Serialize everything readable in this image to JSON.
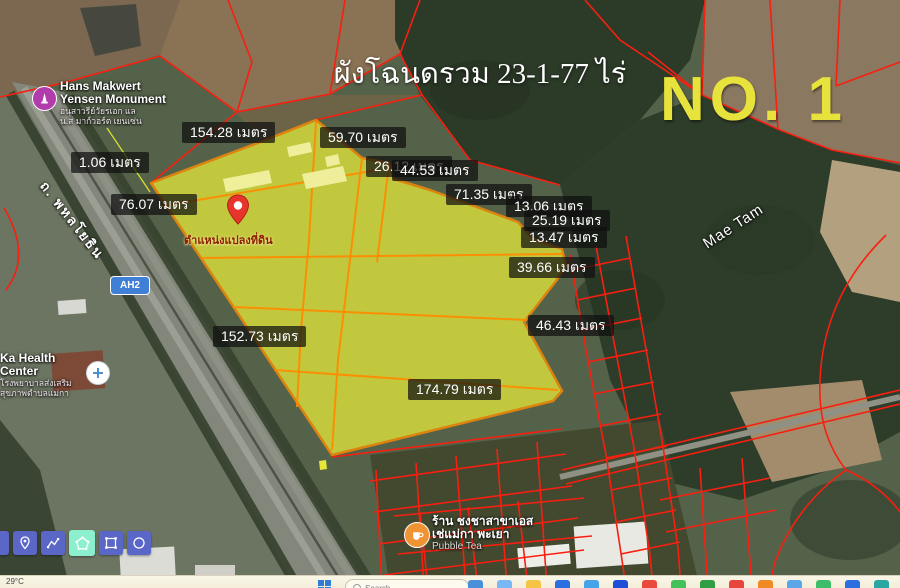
{
  "colors": {
    "parcel_fill": "#dde23c",
    "parcel_border": "#ff8c00",
    "cadastral": "#f81f10",
    "plot_no": "#e8e33c",
    "toolbar_btn": "#5b67c7",
    "toolbar_active": "#8cf0cf",
    "taskbar_bg": "#f3eeda",
    "ah2_bg": "#3f7fd6"
  },
  "header": {
    "title": "ผังโฉนดรวม 23-1-77 ไร่",
    "plot_number": "NO. 1"
  },
  "measurements": [
    {
      "text": "154.28 เมตร",
      "x": 182,
      "y": 122
    },
    {
      "text": "59.70 เมตร",
      "x": 320,
      "y": 127
    },
    {
      "text": "1.06 เมตร",
      "x": 71,
      "y": 152
    },
    {
      "text": "26.12 เมตร",
      "x": 366,
      "y": 156
    },
    {
      "text": "44.53 เมตร",
      "x": 392,
      "y": 160
    },
    {
      "text": "76.07 เมตร",
      "x": 111,
      "y": 194
    },
    {
      "text": "71.35 เมตร",
      "x": 446,
      "y": 184
    },
    {
      "text": "13.06 เมตร",
      "x": 506,
      "y": 196
    },
    {
      "text": "25.19 เมตร",
      "x": 524,
      "y": 210
    },
    {
      "text": "13.47 เมตร",
      "x": 521,
      "y": 227
    },
    {
      "text": "39.66 เมตร",
      "x": 509,
      "y": 257
    },
    {
      "text": "46.43 เมตร",
      "x": 528,
      "y": 315
    },
    {
      "text": "152.73 เมตร",
      "x": 213,
      "y": 326
    },
    {
      "text": "174.79 เมตร",
      "x": 408,
      "y": 379
    }
  ],
  "pin": {
    "label": "ตำแหน่งแปลงที่ดิน"
  },
  "pois": {
    "monument": {
      "name_line1": "Hans Makwert",
      "name_line2": "Yensen Monument",
      "thai_line1": "อนุสาวรีย์วัยรเอก แล",
      "thai_line2": "น.ส มาก์วอร์ต เยนเซ่น"
    },
    "health_center": {
      "name": "Ka Health Center",
      "thai_line1": "โรงพยาบาลส่งเสริม",
      "thai_line2": "สุขภาพตำบลแม่กา"
    },
    "tea_shop": {
      "thai_line1": "ร้าน ชงชาสาขาเอส",
      "thai_line2": "เช่แม่กา พะเยา",
      "sub": "Pubble Tea"
    },
    "area_label": "Mae Tam",
    "road_label": "ถ. พหลโยธิน",
    "route_badge": "AH2"
  },
  "toolbar": {
    "buttons": [
      "marker",
      "polyline",
      "polygon",
      "rectangle",
      "circle"
    ],
    "active": "polygon"
  },
  "taskbar": {
    "temperature": "29°C",
    "search_label": "Search",
    "app_colors": [
      "#4a90d9",
      "#7ab8f5",
      "#f6c445",
      "#2b6fe0",
      "#45a3e8",
      "#1d4ed8",
      "#e84b3c",
      "#44c15a",
      "#2f9e44",
      "#e8453c",
      "#f08a24",
      "#5aa7e8",
      "#3dbd6a",
      "#2b6fe0",
      "#2aa7a0"
    ]
  }
}
